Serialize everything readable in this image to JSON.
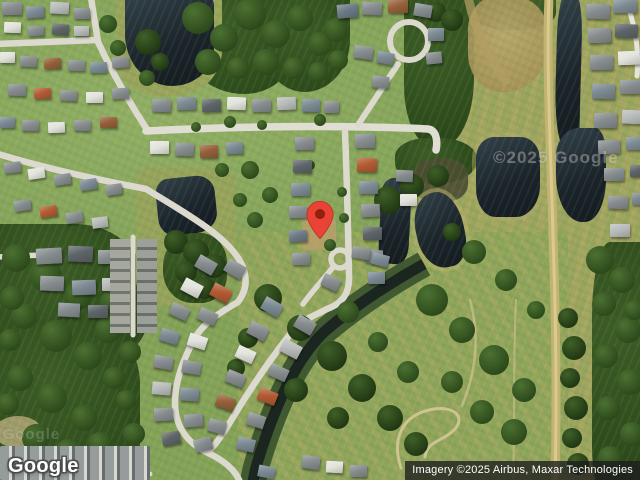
{
  "overlays": {
    "logo": "Google",
    "attribution": "Imagery ©2025 Airbus, Maxar Technologies",
    "watermark": "©2025 Google"
  },
  "marker": {
    "color": "#EA4335",
    "dot_color": "#92200F",
    "outline_color": "#B5362A"
  }
}
